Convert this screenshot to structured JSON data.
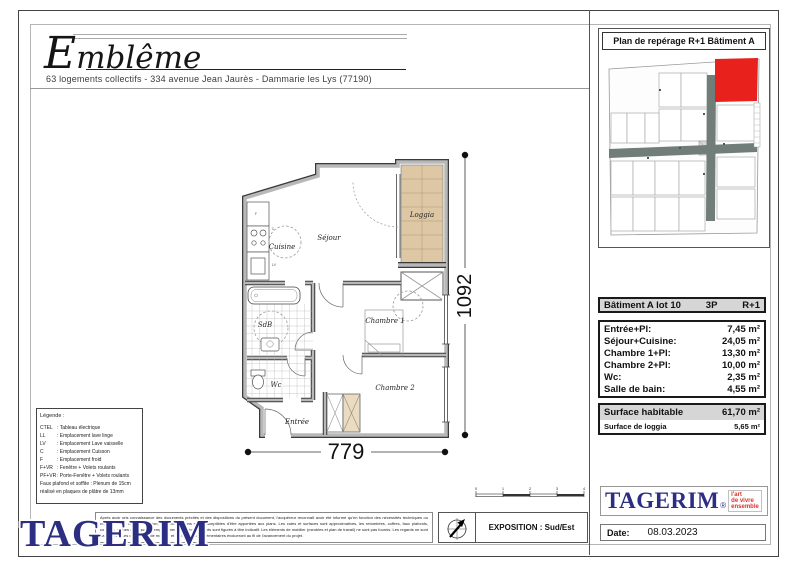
{
  "header": {
    "logo": "Emblême",
    "address": "63 logements collectifs - 334 avenue Jean Jaurès - Dammarie les Lys (77190)"
  },
  "locator": {
    "title": "Plan de repérage R+1 Bâtiment A",
    "highlight_color": "#e8211d"
  },
  "plan": {
    "rooms": {
      "cuisine": "Cuisine",
      "sejour": "Séjour",
      "loggia": "Loggia",
      "sdb": "SdB",
      "wc": "Wc",
      "entree": "Entrée",
      "chambre1": "Chambre 1",
      "chambre2": "Chambre 2"
    },
    "appliances": {
      "f": "F",
      "c": "C",
      "lv": "LV"
    },
    "dim_width": "779",
    "dim_height": "1092"
  },
  "surface_table": {
    "lot": "Bâtiment A lot 10",
    "type": "3P",
    "level": "R+1",
    "rows": [
      {
        "label": "Entrée+Pl:",
        "value": "7,45 m²"
      },
      {
        "label": "Séjour+Cuisine:",
        "value": "24,05 m²"
      },
      {
        "label": "Chambre 1+Pl:",
        "value": "13,30 m²"
      },
      {
        "label": "Chambre 2+Pl:",
        "value": "10,00 m²"
      },
      {
        "label": "Wc:",
        "value": "2,35 m²"
      },
      {
        "label": "Salle de bain:",
        "value": "4,55 m²"
      }
    ],
    "summary": [
      {
        "label": "Surface habitable",
        "value": "61,70 m²"
      },
      {
        "label": "Surface de loggia",
        "value": "5,65 m²"
      }
    ]
  },
  "legend": {
    "title": "Légende :",
    "items": [
      {
        "abbr": "CTEL",
        "desc": ": Tableau électrique"
      },
      {
        "abbr": "LL",
        "desc": ": Emplacement lave linge"
      },
      {
        "abbr": "LV",
        "desc": ": Emplacement Lave vaisselle"
      },
      {
        "abbr": "C",
        "desc": ": Emplacement Cuisson"
      },
      {
        "abbr": "F",
        "desc": ": Emplacement froid"
      },
      {
        "abbr": "F+VR",
        "desc": ": Fenêtre + Volets roulants"
      },
      {
        "abbr": "PF+VR",
        "desc": ": Porte-Fenêtre + Volets roulants"
      }
    ],
    "note_line1": "Faux plafond et soffite : Plenum de 15cm",
    "note_line2": "réalisé en plaques de plâtre de 13mm"
  },
  "footer": {
    "watermark": "TAGERIM",
    "disclaimer": "Après avoir pris connaissance des documents précités et des dispositions du présent document, l'acquéreur reconnaît avoir été informé qu'en fonction des nécessités techniques ou réglementaires de la réalisation, des modifications sont susceptibles d'être apportées aux plans. Les cotes et surfaces sont approximatives, les retombées, coffres, faux plafonds, conduits, gaines ainsi que les emplacements des équipements sont figurés à titre indicatif. Les éléments de mobilier (meubles et plan de travail) ne sont pas fournis. Les regards ne sont pas figurés. Les démarches de mobilier et de toutage complémentaires évolueront au fil de l'avancement du projet.",
    "exposition": "EXPOSITION : Sud/Est",
    "scale_ticks": [
      "0",
      "1",
      "2",
      "3",
      "4"
    ],
    "brand": {
      "name": "TAGERIM",
      "reg": "®",
      "tagline_lines": [
        "l'art",
        "de vivre",
        "ensemble"
      ]
    },
    "date_label": "Date:",
    "date_value": "08.03.2023"
  },
  "colors": {
    "brand_blue": "#2b2e83",
    "tagline_red": "#d9342b",
    "highlight_red": "#e8211d",
    "loggia_tan": "#ddc7a5",
    "wall_gray": "#b8b8b8",
    "table_header_bg": "#d6d6d6"
  }
}
